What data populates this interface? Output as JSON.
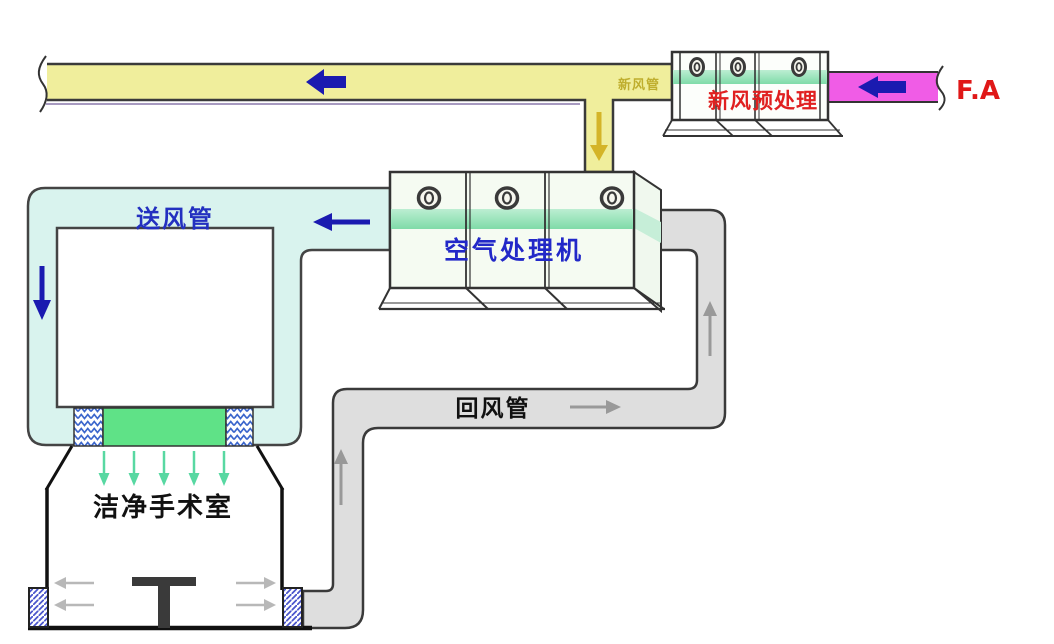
{
  "diagram": {
    "kind": "clean-operating-room-hvac-airflow",
    "units": {
      "pretreatment": {
        "label": "新风预处理"
      },
      "ahu": {
        "label": "空气处理机"
      }
    },
    "ducts": {
      "fresh_air": {
        "label": "新风管"
      },
      "outdoor_air": {
        "label": "F.A"
      },
      "supply": {
        "label": "送风管"
      },
      "return": {
        "label": "回风管"
      }
    },
    "room": {
      "label": "洁净手术室"
    }
  },
  "colors": {
    "fresh_air_duct": "#F0EE9C",
    "outdoor_air_duct": "#F05CE6",
    "supply_duct": "#D9F3EE",
    "return_duct": "#DEDEDE",
    "unit_body": "#F5FBF2",
    "stripe_green": "#84DCAC",
    "diffuser_green": "#5FE287",
    "flow_arrow_navy": "#1A1AB0",
    "flow_arrow_olive": "#D4B428",
    "flow_arrow_gray": "#999999",
    "flow_arrow_teal": "#58D8A2",
    "room_arrow_gray": "#B8B8B8",
    "label_red": "#E02020",
    "label_blue": "#2330C0",
    "label_olive": "#BFAE2E"
  }
}
